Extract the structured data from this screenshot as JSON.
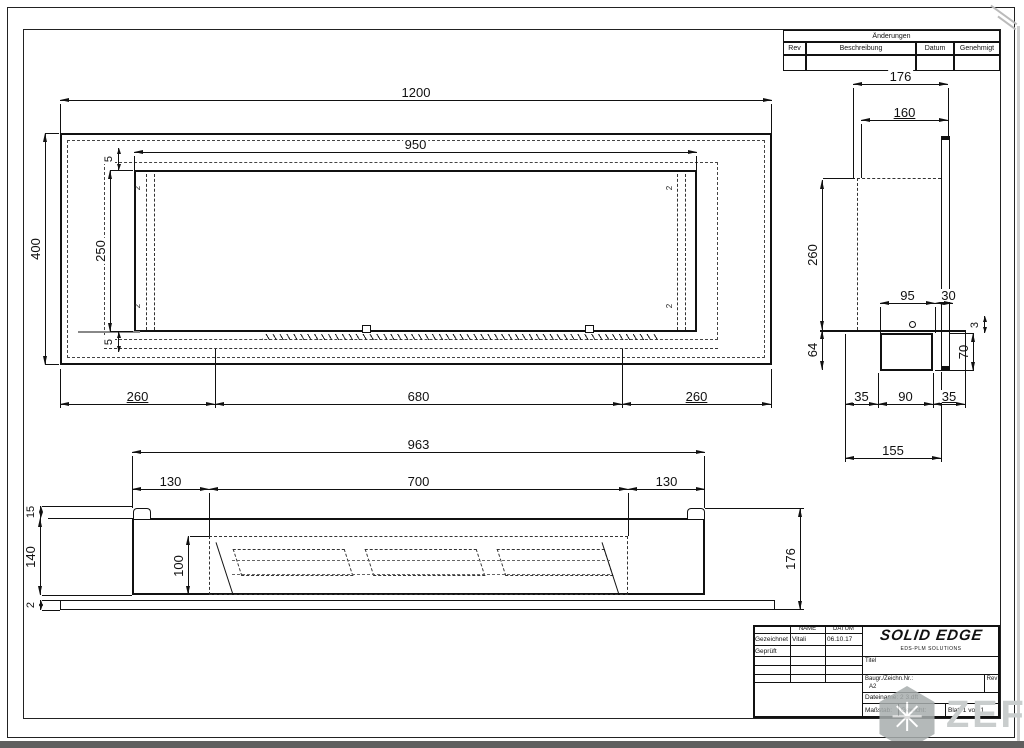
{
  "revision_table": {
    "title": "Änderungen",
    "col_rev": "Rev",
    "col_description": "Beschreibung",
    "col_date": "Datum",
    "col_approved": "Genehmigt"
  },
  "front_view": {
    "dim_overall_width": "1200",
    "dim_opening_width": "950",
    "dim_overall_height": "400",
    "dim_opening_height": "250",
    "dim_gap_top": "5",
    "dim_gap_bottom": "5",
    "dim_left_offset": "260",
    "dim_center_span": "680",
    "dim_right_offset": "260",
    "corner_thickness": "2"
  },
  "side_view": {
    "dim_depth_total": "176",
    "dim_depth_inner": "160",
    "dim_upper_height": "260",
    "dim_burner_width": "95",
    "dim_panel_width": "30",
    "dim_gap": "3",
    "dim_lower_height": "64",
    "dim_box_height": "70",
    "dim_offset_left": "35",
    "dim_box_span": "90",
    "dim_offset_right": "35",
    "dim_base_depth": "155"
  },
  "bottom_view": {
    "dim_body_width": "963",
    "dim_left_offset": "130",
    "dim_opening_width": "700",
    "dim_right_offset": "130",
    "dim_flange_height": "15",
    "dim_body_depth": "140",
    "dim_plate_thickness": "2",
    "dim_opening_depth": "100",
    "dim_total_height": "176"
  },
  "title_block": {
    "col_name": "NAME",
    "col_date": "DATUM",
    "row_drawn": "Gezeichnet",
    "row_checked": "Geprüft",
    "drawn_name": "Vitali",
    "drawn_date": "06.10.17",
    "logo": "SOLID EDGE",
    "logo_sub": "EDS-PLM SOLUTIONS",
    "title_label": "Titel",
    "drawing_no_label": "Baugr./Zeichn.Nr.:",
    "sheet_size": "A2",
    "rev_label": "Rev",
    "filename": "Dateiname: 2 3.dft",
    "scale_label": "Maßstab:",
    "weight_label": "Gewicht:",
    "sheet_label": "Blatt 1 von 1"
  },
  "watermark": {
    "text": "ZEFIRE",
    "glyph": "✳"
  }
}
